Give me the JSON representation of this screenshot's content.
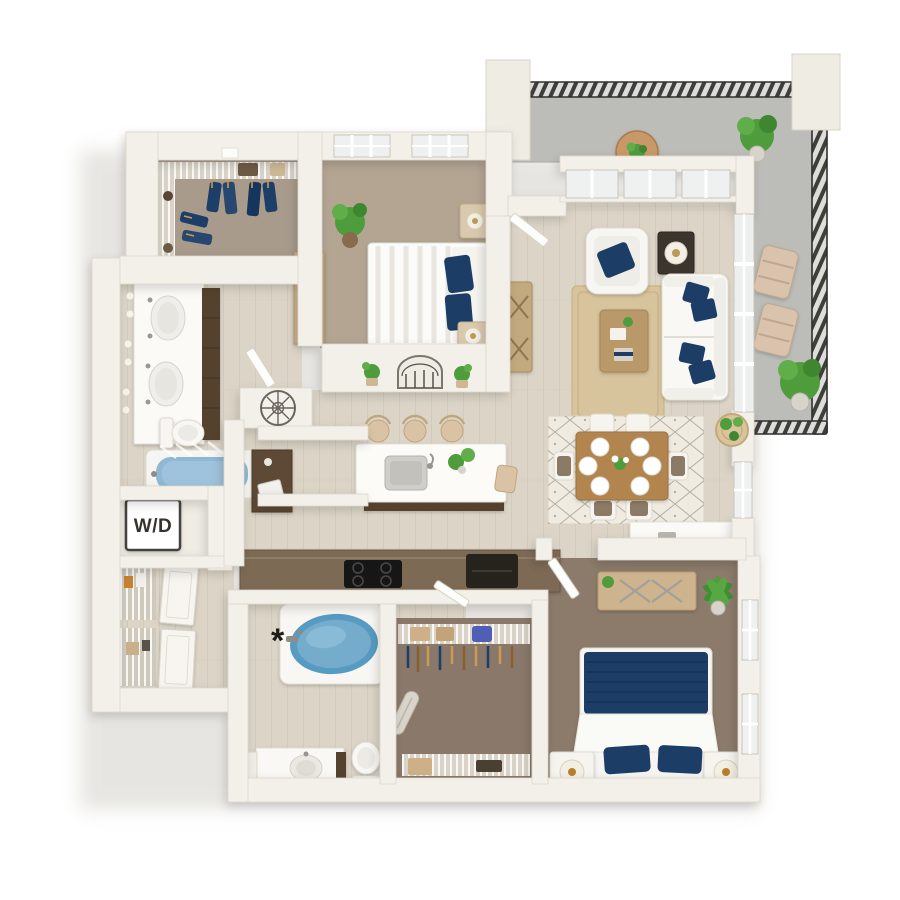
{
  "floorplan": {
    "labels": {
      "washer_dryer": "W/D",
      "tub_note": "*"
    },
    "colors": {
      "background": "#ffffff",
      "wall": "#f3f0e9",
      "wall_edge": "#dcd7cb",
      "wood_floor": "#dcd5c7",
      "plank_line": "#c8c0b0",
      "carpet_bedroom1": "#b4a593",
      "carpet_closet1": "#a89b8c",
      "carpet_dark": "#8c7b6b",
      "balcony_concrete": "#bcbcb8",
      "railing_dark": "#3f3f3a",
      "accent_navy": "#1d3e66",
      "tub_water": "#74abcb",
      "jute_rug": "#d8c49c",
      "dining_rug": "#efebe1",
      "wood_table": "#b2854f",
      "light_wood": "#cdb38e",
      "cabinet_dark": "#55432f",
      "counter_wood": "#7c6a55",
      "appliance_black": "#1b1917",
      "plant_green": "#4f9c3c",
      "fixture_white": "#fbfaf7"
    },
    "rooms": [
      {
        "name": "walk-in-closet-1",
        "furnishings": [
          "wire-shelving",
          "hanging-clothes",
          "storage-boxes"
        ]
      },
      {
        "name": "bedroom-1",
        "furnishings": [
          "bed-white-striped-duvet",
          "navy-pillows",
          "two-nightstands",
          "lamps",
          "dresser",
          "potted-plant",
          "two-windows"
        ]
      },
      {
        "name": "bathroom-1",
        "furnishings": [
          "double-vanity",
          "sconce-lights",
          "toilet",
          "tub-with-shower",
          "wall-medallion"
        ]
      },
      {
        "name": "laundry-closet",
        "label": "W/D"
      },
      {
        "name": "pantry-shelves",
        "furnishings": [
          "wire-shelves",
          "linen-closet-doors"
        ]
      },
      {
        "name": "kitchen",
        "furnishings": [
          "island-with-sink",
          "three-bar-stools",
          "end-chair",
          "cooktop",
          "counter",
          "desk-nook"
        ]
      },
      {
        "name": "dining-area",
        "furnishings": [
          "wood-table",
          "six-place-settings",
          "six-chairs",
          "diamond-rug",
          "wall-plant-basket",
          "window"
        ]
      },
      {
        "name": "living-room",
        "furnishings": [
          "sofa-navy-pillows",
          "armchair-navy-pillow",
          "side-table-lamp",
          "coffee-table",
          "jute-rug",
          "tv-console",
          "window-wall",
          "sliding-glass-door"
        ]
      },
      {
        "name": "balcony",
        "furnishings": [
          "slatted-railing",
          "two-lounge-chairs",
          "bistro-table",
          "potted-plants",
          "pillars"
        ]
      },
      {
        "name": "bathroom-2",
        "note": "*",
        "furnishings": [
          "oval-soaking-tub",
          "vanity",
          "three-lights",
          "toilet"
        ]
      },
      {
        "name": "walk-in-closet-2",
        "furnishings": [
          "wire-shelving",
          "hangers",
          "ironing-board",
          "storage-boxes"
        ]
      },
      {
        "name": "bedroom-2",
        "furnishings": [
          "bed-navy-duvet",
          "navy-pillows",
          "two-nightstands",
          "round-lamps",
          "dresser",
          "palm-plant",
          "two-windows"
        ]
      }
    ]
  }
}
